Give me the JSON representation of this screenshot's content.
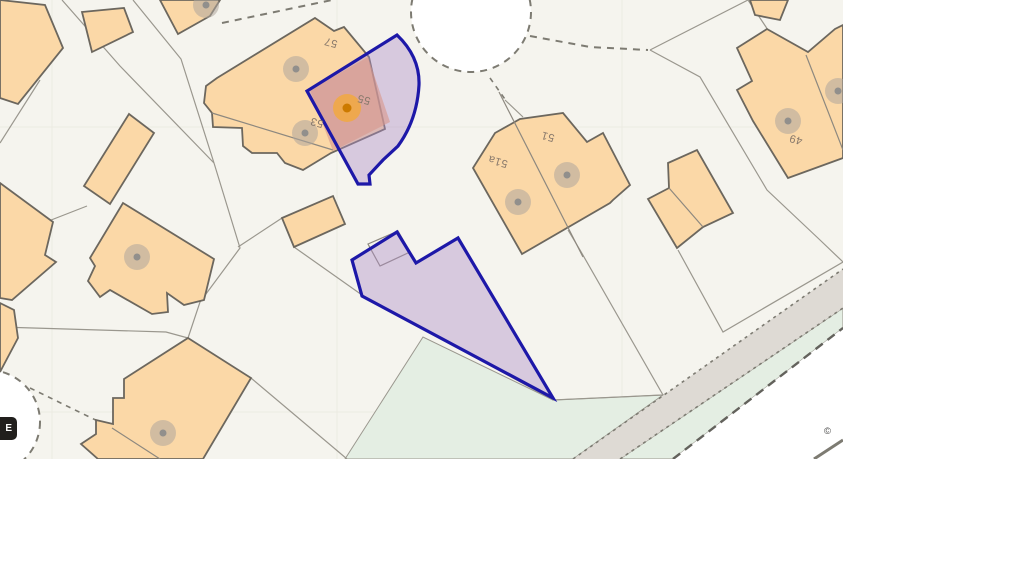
{
  "page": {
    "width": 1014,
    "height": 570,
    "background": "#ffffff"
  },
  "map": {
    "width": 843,
    "height": 459,
    "badge_label": "E",
    "attribution": "©",
    "label_rotation": 196,
    "palette": {
      "land": "#f5f4ee",
      "grid": "#ecebe2",
      "green": "#e4eee3",
      "road_band": "#dedad4",
      "white": "#ffffff",
      "parcel_line": "#9a978e",
      "building_fill": "#fbd8a7",
      "building_stroke": "#6c675e",
      "division_line": "#8d887f",
      "dash_color": "#7d7b72",
      "heavy_dash": "#63625c",
      "purple_fill": "#af8cc9",
      "purple_stroke": "#1d18a8",
      "salmon": "#d8978c",
      "marker_outer": "#afa69d",
      "marker_inner": "#8a8a8a",
      "selected_outer": "#f2a93b",
      "selected_inner": "#cc7a00",
      "label_color": "#87786b",
      "pond_fill": "#ffffff"
    },
    "gridlines": {
      "vertical": [
        52,
        337,
        622
      ],
      "horizontal": [
        127,
        412
      ]
    },
    "green_areas": [
      [
        [
          345,
          459
        ],
        [
          423,
          337
        ],
        [
          553,
          400
        ],
        [
          663,
          395
        ],
        [
          573,
          459
        ]
      ],
      [
        [
          620,
          459
        ],
        [
          843,
          308
        ],
        [
          843,
          328
        ],
        [
          673,
          459
        ]
      ]
    ],
    "road_band": [
      [
        573,
        459
      ],
      [
        843,
        269
      ],
      [
        843,
        308
      ],
      [
        620,
        459
      ]
    ],
    "white_corner": [
      [
        673,
        459
      ],
      [
        843,
        328
      ],
      [
        843,
        459
      ]
    ],
    "ponds": [
      {
        "cx": 471,
        "cy": 12,
        "r": 60
      },
      {
        "cx": -12,
        "cy": 422,
        "r": 52
      }
    ],
    "parcel_lines": [
      [
        [
          62,
          0
        ],
        [
          120,
          66
        ],
        [
          214,
          163
        ]
      ],
      [
        [
          133,
          0
        ],
        [
          181,
          59
        ],
        [
          214,
          163
        ]
      ],
      [
        [
          214,
          163
        ],
        [
          240,
          248
        ],
        [
          200,
          302
        ],
        [
          188,
          338
        ]
      ],
      [
        [
          0,
          327
        ],
        [
          166,
          332
        ],
        [
          188,
          338
        ]
      ],
      [
        [
          251,
          378
        ],
        [
          347,
          459
        ]
      ],
      [
        [
          0,
          143
        ],
        [
          40,
          80
        ]
      ],
      [
        [
          0,
          240
        ],
        [
          87,
          206
        ]
      ],
      [
        [
          238,
          247
        ],
        [
          282,
          218
        ]
      ],
      [
        [
          294,
          247
        ],
        [
          362,
          295
        ]
      ],
      [
        [
          362,
          295
        ],
        [
          553,
          400
        ],
        [
          663,
          395
        ]
      ],
      [
        [
          568,
          230
        ],
        [
          580,
          250
        ],
        [
          663,
          395
        ]
      ],
      [
        [
          678,
          250
        ],
        [
          723,
          332
        ],
        [
          843,
          262
        ]
      ],
      [
        [
          650,
          50
        ],
        [
          700,
          77
        ],
        [
          767,
          190
        ],
        [
          820,
          240
        ],
        [
          843,
          262
        ]
      ],
      [
        [
          650,
          50
        ],
        [
          748,
          0
        ]
      ],
      [
        [
          748,
          0
        ],
        [
          768,
          30
        ]
      ],
      [
        [
          505,
          100
        ],
        [
          523,
          117
        ]
      ]
    ],
    "dashed_lines": [
      {
        "pts": [
          [
            222,
            23
          ],
          [
            332,
            0
          ]
        ],
        "w": 2,
        "dash": "7 6",
        "heavy": false
      },
      {
        "pts": [
          [
            530,
            36
          ],
          [
            590,
            47
          ],
          [
            648,
            50
          ]
        ],
        "w": 2,
        "dash": "7 6",
        "heavy": false
      },
      {
        "pts": [
          [
            490,
            78
          ],
          [
            507,
            102
          ]
        ],
        "w": 1.6,
        "dash": "5 5",
        "heavy": false
      },
      {
        "pts": [
          [
            30,
            388
          ],
          [
            112,
            428
          ]
        ],
        "w": 1.6,
        "dash": "5 5",
        "heavy": false
      },
      {
        "pts": [
          [
            573,
            459
          ],
          [
            843,
            269
          ]
        ],
        "w": 1.6,
        "dash": "3 4",
        "heavy": false
      },
      {
        "pts": [
          [
            620,
            459
          ],
          [
            843,
            308
          ]
        ],
        "w": 1.6,
        "dash": "3 4",
        "heavy": false
      },
      {
        "pts": [
          [
            673,
            459
          ],
          [
            843,
            328
          ]
        ],
        "w": 2.4,
        "dash": "9 6",
        "heavy": true
      },
      {
        "pts": [
          [
            814,
            459
          ],
          [
            843,
            440
          ]
        ],
        "w": 3,
        "dash": "",
        "heavy": false
      }
    ],
    "structures": [
      [
        [
          368,
          244
        ],
        [
          398,
          231
        ],
        [
          410,
          252
        ],
        [
          380,
          266
        ]
      ]
    ],
    "buildings": [
      [
        [
          0,
          0
        ],
        [
          45,
          5
        ],
        [
          63,
          48
        ],
        [
          18,
          104
        ],
        [
          0,
          98
        ]
      ],
      [
        [
          82,
          12
        ],
        [
          124,
          8
        ],
        [
          133,
          32
        ],
        [
          92,
          52
        ]
      ],
      [
        [
          160,
          0
        ],
        [
          220,
          0
        ],
        [
          210,
          16
        ],
        [
          178,
          34
        ]
      ],
      [
        [
          129,
          114
        ],
        [
          154,
          133
        ],
        [
          110,
          204
        ],
        [
          84,
          186
        ]
      ],
      [
        [
          123,
          203
        ],
        [
          214,
          259
        ],
        [
          204,
          300
        ],
        [
          184,
          305
        ],
        [
          167,
          293
        ],
        [
          168,
          312
        ],
        [
          152,
          314
        ],
        [
          110,
          290
        ],
        [
          100,
          297
        ],
        [
          88,
          281
        ],
        [
          95,
          266
        ],
        [
          90,
          258
        ]
      ],
      [
        [
          188,
          338
        ],
        [
          251,
          378
        ],
        [
          203,
          459
        ],
        [
          98,
          459
        ],
        [
          81,
          444
        ],
        [
          96,
          434
        ],
        [
          96,
          420
        ],
        [
          113,
          424
        ],
        [
          113,
          398
        ],
        [
          124,
          398
        ],
        [
          124,
          379
        ]
      ],
      [
        [
          0,
          303
        ],
        [
          14,
          310
        ],
        [
          18,
          338
        ],
        [
          0,
          372
        ]
      ],
      [
        [
          0,
          183
        ],
        [
          53,
          222
        ],
        [
          45,
          255
        ],
        [
          56,
          262
        ],
        [
          12,
          300
        ],
        [
          0,
          298
        ]
      ],
      [
        [
          315,
          18
        ],
        [
          334,
          31
        ],
        [
          344,
          27
        ],
        [
          369,
          57
        ],
        [
          385,
          129
        ],
        [
          331,
          153
        ],
        [
          303,
          170
        ],
        [
          285,
          163
        ],
        [
          277,
          153
        ],
        [
          252,
          153
        ],
        [
          243,
          146
        ],
        [
          242,
          128
        ],
        [
          213,
          127
        ],
        [
          212,
          113
        ],
        [
          204,
          103
        ],
        [
          206,
          86
        ],
        [
          217,
          78
        ]
      ],
      [
        [
          282,
          218
        ],
        [
          333,
          196
        ],
        [
          345,
          224
        ],
        [
          294,
          247
        ]
      ],
      [
        [
          668,
          163
        ],
        [
          697,
          150
        ],
        [
          733,
          213
        ],
        [
          703,
          227
        ],
        [
          677,
          248
        ],
        [
          648,
          199
        ],
        [
          669,
          188
        ]
      ],
      [
        [
          473,
          168
        ],
        [
          495,
          133
        ],
        [
          520,
          119
        ],
        [
          563,
          113
        ],
        [
          587,
          142
        ],
        [
          603,
          133
        ],
        [
          630,
          185
        ],
        [
          613,
          200
        ],
        [
          610,
          203
        ],
        [
          522,
          254
        ]
      ],
      [
        [
          750,
          0
        ],
        [
          788,
          0
        ],
        [
          780,
          20
        ],
        [
          755,
          15
        ]
      ],
      [
        [
          767,
          29
        ],
        [
          737,
          48
        ],
        [
          752,
          81
        ],
        [
          737,
          90
        ],
        [
          753,
          121
        ],
        [
          788,
          178
        ],
        [
          843,
          158
        ],
        [
          843,
          25
        ],
        [
          835,
          29
        ],
        [
          808,
          52
        ]
      ]
    ],
    "division_lines": [
      [
        [
          212,
          113
        ],
        [
          333,
          150
        ]
      ],
      [
        [
          669,
          188
        ],
        [
          703,
          227
        ]
      ],
      [
        [
          499,
          92
        ],
        [
          583,
          257
        ]
      ],
      [
        [
          112,
          428
        ],
        [
          160,
          459
        ]
      ],
      [
        [
          806,
          55
        ],
        [
          843,
          150
        ]
      ]
    ],
    "highlight": {
      "upper_plot_path": "M397,35 Q420,57 419,85 Q417,120 398,146 L383,160 L369,175 L370,184 L358,184 L307,91 Z",
      "lower_plot": [
        [
          397,
          232
        ],
        [
          416,
          263
        ],
        [
          458,
          238
        ],
        [
          553,
          398
        ],
        [
          362,
          296
        ],
        [
          352,
          260
        ]
      ],
      "house_overlay": [
        [
          310,
          90
        ],
        [
          368,
          57
        ],
        [
          390,
          122
        ],
        [
          333,
          151
        ]
      ]
    },
    "markers": [
      [
        206,
        5
      ],
      [
        296,
        69
      ],
      [
        305,
        133
      ],
      [
        137,
        257
      ],
      [
        163,
        433
      ],
      [
        518,
        202
      ],
      [
        567,
        175
      ],
      [
        788,
        121
      ],
      [
        838,
        91
      ]
    ],
    "selected_marker": [
      347,
      108
    ],
    "labels": [
      {
        "text": "57",
        "x": 331,
        "y": 42
      },
      {
        "text": "55",
        "x": 364,
        "y": 99
      },
      {
        "text": "53",
        "x": 317,
        "y": 122
      },
      {
        "text": "51",
        "x": 548,
        "y": 136
      },
      {
        "text": "51a",
        "x": 498,
        "y": 161
      },
      {
        "text": "49",
        "x": 796,
        "y": 139
      }
    ]
  }
}
